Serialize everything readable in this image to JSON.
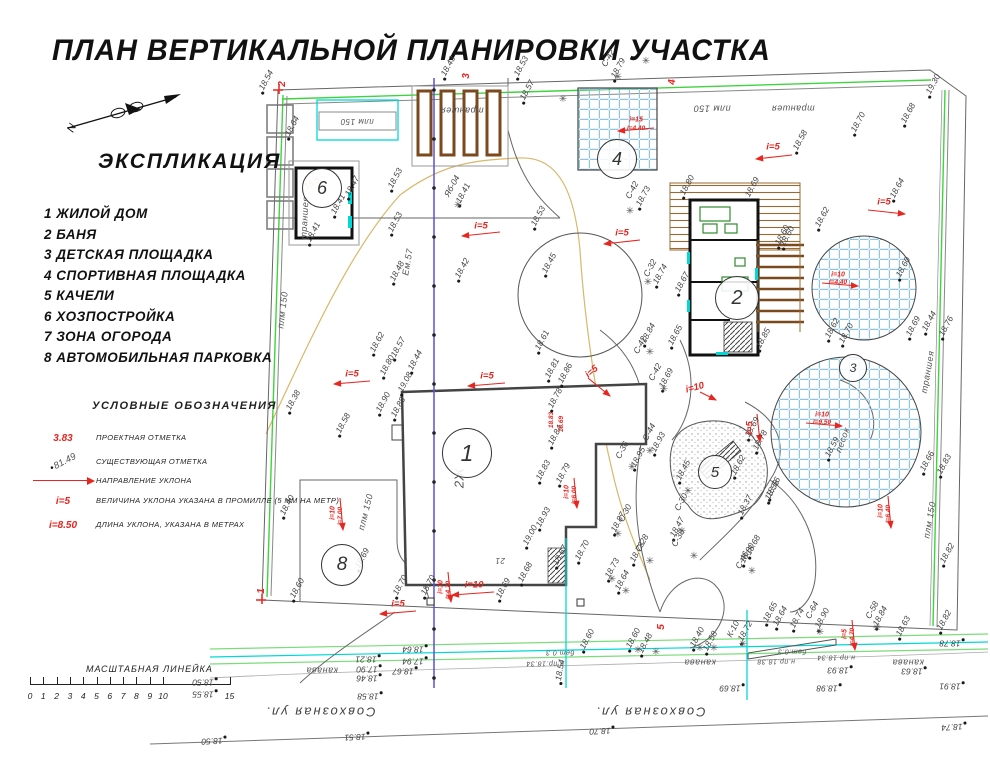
{
  "title": "ПЛАН ВЕРТИКАЛЬНОЙ ПЛАНИРОВКИ УЧАСТКА",
  "north_label": "N",
  "explication": {
    "heading": "ЭКСПЛИКАЦИЯ",
    "items": [
      "1 ЖИЛОЙ ДОМ",
      "2 БАНЯ",
      "3 ДЕТСКАЯ ПЛОЩАДКА",
      "4 СПОРТИВНАЯ ПЛОЩАДКА",
      "5 КАЧЕЛИ",
      "6 ХОЗПОСТРОЙКА",
      "7 ЗОНА ОГОРОДА",
      "8 АВТОМОБИЛЬНАЯ ПАРКОВКА"
    ]
  },
  "legend": {
    "heading": "УСЛОВНЫЕ ОБОЗНАЧЕНИЯ",
    "rows": [
      {
        "symbol": "3.83",
        "style": "red",
        "desc": "ПРОЕКТНАЯ ОТМЕТКА"
      },
      {
        "symbol": "81.49",
        "style": "exist",
        "desc": "СУЩЕСТВУЮЩАЯ ОТМЕТКА"
      },
      {
        "symbol": "",
        "style": "arrow",
        "desc": "НАПРАВЛЕНИЕ УКЛОНА"
      },
      {
        "symbol": "i=5",
        "style": "red",
        "desc": "ВЕЛИЧИНА УКЛОНА УКАЗАНА В ПРОМИЛЛЕ (5 ММ НА МЕТР)"
      },
      {
        "symbol": "i=8.50",
        "style": "red",
        "desc": "ДЛИНА УКЛОНА, УКАЗАНА В МЕТРАХ"
      }
    ]
  },
  "scale_bar": {
    "label": "МАСШТАБНАЯ ЛИНЕЙКА",
    "ticks": [
      "0",
      "1",
      "2",
      "3",
      "4",
      "5",
      "6",
      "7",
      "8",
      "9",
      "10",
      "15"
    ]
  },
  "plan": {
    "colors": {
      "red": "#e8251f",
      "fence_green": "#3fd43f",
      "light_green": "#7bdc7b",
      "cyan": "#00d8d8",
      "cable_blue": "#5a50d8",
      "contour_tan": "#d8b86a",
      "grid_blue": "#8fc6dd",
      "wood_brown": "#9a6a33"
    },
    "circles": [
      [
        "1",
        466,
        452,
        24
      ],
      [
        "2",
        736,
        297,
        21
      ],
      [
        "3",
        852,
        367,
        13
      ],
      [
        "4",
        616,
        158,
        19
      ],
      [
        "5",
        714,
        471,
        16
      ],
      [
        "6",
        321,
        187,
        19
      ],
      [
        "8",
        341,
        564,
        20
      ]
    ],
    "trees": [
      [
        618,
        78
      ],
      [
        646,
        62
      ],
      [
        563,
        100
      ],
      [
        630,
        212
      ],
      [
        648,
        283
      ],
      [
        650,
        353
      ],
      [
        664,
        390
      ],
      [
        650,
        452
      ],
      [
        632,
        468
      ],
      [
        618,
        535
      ],
      [
        650,
        562
      ],
      [
        688,
        492
      ],
      [
        682,
        532
      ],
      [
        694,
        557
      ],
      [
        752,
        572
      ],
      [
        612,
        580
      ],
      [
        626,
        592
      ],
      [
        638,
        651
      ],
      [
        656,
        653
      ],
      [
        700,
        649
      ],
      [
        714,
        649
      ],
      [
        743,
        645
      ],
      [
        820,
        633
      ],
      [
        877,
        629
      ],
      [
        458,
        206
      ]
    ],
    "labels": [
      [
        "18.54",
        266,
        80,
        -62,
        "e"
      ],
      [
        "18.64",
        292,
        126,
        -62,
        "e"
      ],
      [
        "18.47",
        352,
        186,
        -62,
        "e"
      ],
      [
        "18.41",
        338,
        204,
        -62,
        "e"
      ],
      [
        "18.41",
        313,
        232,
        -62,
        "e"
      ],
      [
        "18.53",
        395,
        178,
        -62,
        "e"
      ],
      [
        "18.53",
        395,
        222,
        -62,
        "e"
      ],
      [
        "18.48",
        397,
        271,
        -62,
        "e"
      ],
      [
        "18.43",
        448,
        66,
        -62,
        "e"
      ],
      [
        "18.53",
        521,
        66,
        -62,
        "e"
      ],
      [
        "18.57",
        527,
        90,
        -62,
        "e"
      ],
      [
        "18.53",
        538,
        216,
        -62,
        "e"
      ],
      [
        "18.45",
        549,
        263,
        -62,
        "e"
      ],
      [
        "18.42",
        462,
        268,
        -62,
        "e"
      ],
      [
        "18.41",
        463,
        193,
        -62,
        "e"
      ],
      [
        "18.40",
        287,
        505,
        -62,
        "e"
      ],
      [
        "18.38",
        293,
        400,
        -62,
        "e"
      ],
      [
        "18.58",
        343,
        423,
        -62,
        "e"
      ],
      [
        "18.79",
        618,
        68,
        -62,
        "e"
      ],
      [
        "19.30",
        933,
        84,
        -62,
        "e"
      ],
      [
        "18.68",
        908,
        113,
        -62,
        "e"
      ],
      [
        "18.70",
        858,
        122,
        -62,
        "e"
      ],
      [
        "18.58",
        800,
        140,
        -62,
        "e"
      ],
      [
        "18.64",
        897,
        188,
        -62,
        "e"
      ],
      [
        "18.62",
        822,
        217,
        -62,
        "e"
      ],
      [
        "18.60",
        782,
        235,
        -62,
        "e"
      ],
      [
        "18.80",
        687,
        185,
        -62,
        "e"
      ],
      [
        "18.69",
        752,
        187,
        -62,
        "e"
      ],
      [
        "18.73",
        643,
        196,
        -62,
        "e"
      ],
      [
        "18.74",
        660,
        274,
        -62,
        "e"
      ],
      [
        "18.67",
        682,
        282,
        -62,
        "e"
      ],
      [
        "18.65",
        675,
        335,
        -62,
        "e"
      ],
      [
        "18.85",
        763,
        338,
        -62,
        "e"
      ],
      [
        "18.84",
        648,
        333,
        -62,
        "e"
      ],
      [
        "18.69",
        666,
        378,
        -62,
        "e"
      ],
      [
        "18.62",
        377,
        342,
        -62,
        "e"
      ],
      [
        "18.57",
        398,
        347,
        -62,
        "e"
      ],
      [
        "18.44",
        415,
        360,
        -62,
        "e"
      ],
      [
        "18.80",
        387,
        365,
        -62,
        "e"
      ],
      [
        "19.08",
        405,
        382,
        -62,
        "e"
      ],
      [
        "18.90",
        383,
        402,
        -62,
        "e"
      ],
      [
        "18.88",
        398,
        407,
        -62,
        "e"
      ],
      [
        "18.61",
        542,
        340,
        -62,
        "e"
      ],
      [
        "18.81",
        552,
        368,
        -62,
        "e"
      ],
      [
        "18.86",
        565,
        373,
        -62,
        "e"
      ],
      [
        "18.78",
        555,
        398,
        -62,
        "e"
      ],
      [
        "18.84",
        555,
        435,
        -62,
        "e"
      ],
      [
        "18.83",
        543,
        470,
        -62,
        "e"
      ],
      [
        "18.79",
        563,
        473,
        -62,
        "e"
      ],
      [
        "18.93",
        543,
        517,
        -62,
        "e"
      ],
      [
        "19.00",
        530,
        535,
        -62,
        "e"
      ],
      [
        "18.67",
        560,
        555,
        -62,
        "e"
      ],
      [
        "18.70",
        582,
        550,
        -62,
        "e"
      ],
      [
        "18.68",
        525,
        572,
        -62,
        "e"
      ],
      [
        "18.69",
        503,
        588,
        -62,
        "e"
      ],
      [
        "18.70",
        400,
        585,
        -62,
        "e"
      ],
      [
        "18.60",
        787,
        236,
        -62,
        "e"
      ],
      [
        "18.60",
        903,
        267,
        -62,
        "e"
      ],
      [
        "18.62",
        832,
        328,
        -62,
        "e"
      ],
      [
        "18.70",
        846,
        333,
        -62,
        "e"
      ],
      [
        "18.69",
        913,
        326,
        -62,
        "e"
      ],
      [
        "18.44",
        929,
        321,
        -62,
        "e"
      ],
      [
        "18.76",
        946,
        326,
        -62,
        "e"
      ],
      [
        "18.59",
        832,
        447,
        -62,
        "e"
      ],
      [
        "18.56",
        773,
        487,
        -62,
        "e"
      ],
      [
        "18.66",
        927,
        461,
        -62,
        "e"
      ],
      [
        "18.83",
        944,
        464,
        -62,
        "e"
      ],
      [
        "18.93",
        658,
        442,
        -62,
        "e"
      ],
      [
        "18.95",
        638,
        457,
        -62,
        "e"
      ],
      [
        "18.87",
        618,
        522,
        -62,
        "e"
      ],
      [
        "18.78",
        637,
        552,
        -62,
        "e"
      ],
      [
        "18.73",
        612,
        568,
        -62,
        "e"
      ],
      [
        "18.64",
        622,
        580,
        -62,
        "e"
      ],
      [
        "18.45",
        683,
        470,
        -62,
        "e"
      ],
      [
        "18.47",
        677,
        527,
        -62,
        "e"
      ],
      [
        "18.62",
        738,
        465,
        -62,
        "e"
      ],
      [
        "18.78",
        760,
        440,
        -62,
        "e"
      ],
      [
        "18.69",
        752,
        427,
        -62,
        "e"
      ],
      [
        "18.37",
        745,
        505,
        -62,
        "e"
      ],
      [
        "18.56",
        772,
        490,
        -62,
        "e"
      ],
      [
        "18.80",
        747,
        553,
        -62,
        "e"
      ],
      [
        "18.68",
        753,
        545,
        -62,
        "e"
      ],
      [
        "18.60",
        633,
        638,
        -62,
        "e"
      ],
      [
        "18.48",
        645,
        643,
        -62,
        "e"
      ],
      [
        "18.40",
        697,
        637,
        -62,
        "e"
      ],
      [
        "18.58",
        710,
        641,
        -62,
        "e"
      ],
      [
        "18.72",
        745,
        631,
        -62,
        "e"
      ],
      [
        "18.65",
        770,
        612,
        -62,
        "e"
      ],
      [
        "18.64",
        780,
        616,
        -62,
        "e"
      ],
      [
        "18.74",
        797,
        618,
        -62,
        "e"
      ],
      [
        "18.90",
        822,
        618,
        -62,
        "e"
      ],
      [
        "18.84",
        880,
        616,
        -62,
        "e"
      ],
      [
        "18.63",
        903,
        626,
        -62,
        "e"
      ],
      [
        "18.82",
        944,
        620,
        -62,
        "e"
      ],
      [
        "18.82",
        947,
        553,
        -62,
        "e"
      ],
      [
        "18.60",
        587,
        639,
        -62,
        "e"
      ],
      [
        "18.69",
        362,
        558,
        -62,
        "e"
      ],
      [
        "18.60",
        297,
        588,
        -62,
        "e"
      ],
      [
        "18.70",
        428,
        585,
        -62,
        "e"
      ],
      [
        "18.50",
        203,
        682,
        180,
        "e"
      ],
      [
        "18.55",
        203,
        694,
        180,
        "e"
      ],
      [
        "18.64",
        413,
        649,
        180,
        "e"
      ],
      [
        "17.94",
        413,
        661,
        180,
        "e"
      ],
      [
        "18.67",
        403,
        671,
        180,
        "e"
      ],
      [
        "18.21",
        366,
        659,
        180,
        "e"
      ],
      [
        "17.90",
        367,
        669,
        180,
        "e"
      ],
      [
        "18.46",
        367,
        678,
        180,
        "e"
      ],
      [
        "18.58",
        368,
        696,
        180,
        "e"
      ],
      [
        "18.69",
        730,
        688,
        180,
        "e"
      ],
      [
        "18.98",
        827,
        688,
        180,
        "e"
      ],
      [
        "18.93",
        838,
        670,
        180,
        "e"
      ],
      [
        "18.63",
        912,
        671,
        180,
        "e"
      ],
      [
        "18.91",
        950,
        686,
        180,
        "e"
      ],
      [
        "18.78",
        950,
        643,
        180,
        "e"
      ],
      [
        "18.54",
        560,
        670,
        -80,
        "e"
      ],
      [
        "18.50",
        212,
        741,
        177,
        "e"
      ],
      [
        "18.51",
        355,
        737,
        177,
        "e"
      ],
      [
        "18.70",
        600,
        731,
        177,
        "e"
      ],
      [
        "18.74",
        952,
        727,
        177,
        "e"
      ],
      [
        "С-42",
        608,
        58,
        -62,
        "s"
      ],
      [
        "С-42",
        632,
        190,
        -62,
        "s"
      ],
      [
        "С-32",
        650,
        268,
        -62,
        "s"
      ],
      [
        "С-42",
        640,
        345,
        -62,
        "s"
      ],
      [
        "С-42",
        655,
        372,
        -62,
        "s"
      ],
      [
        "С-44",
        649,
        432,
        -62,
        "s"
      ],
      [
        "С-36",
        622,
        450,
        -62,
        "s"
      ],
      [
        "С-30",
        625,
        513,
        -62,
        "s"
      ],
      [
        "С-30",
        681,
        502,
        -62,
        "s"
      ],
      [
        "С-28",
        642,
        543,
        -62,
        "s"
      ],
      [
        "С-38",
        678,
        538,
        -62,
        "s"
      ],
      [
        "С-46",
        742,
        560,
        -62,
        "s"
      ],
      [
        "С-58",
        872,
        610,
        -62,
        "s"
      ],
      [
        "К-10",
        733,
        629,
        -62,
        "s"
      ],
      [
        "С-64",
        812,
        610,
        -62,
        "s"
      ],
      [
        "Яб-04",
        452,
        186,
        -62,
        "s"
      ],
      [
        "i=5",
        481,
        226,
        0,
        "p"
      ],
      [
        "i=5",
        773,
        147,
        0,
        "p"
      ],
      [
        "i=5",
        884,
        202,
        0,
        "p"
      ],
      [
        "i=5",
        622,
        233,
        0,
        "p"
      ],
      [
        "i=5",
        487,
        376,
        0,
        "p"
      ],
      [
        "i=5",
        352,
        374,
        0,
        "p"
      ],
      [
        "i=5",
        398,
        604,
        0,
        "p"
      ],
      [
        "i=10",
        474,
        585,
        0,
        "p"
      ],
      [
        "i=5",
        592,
        372,
        -40,
        "p"
      ],
      [
        "i=5",
        750,
        428,
        -90,
        "p"
      ],
      [
        "i=10",
        695,
        388,
        -15,
        "p"
      ],
      [
        "i=15",
        636,
        120,
        0,
        "p",
        7
      ],
      [
        "l=4.40",
        636,
        129,
        0,
        "p",
        6.5
      ],
      [
        "i=10",
        838,
        275,
        0,
        "p",
        7
      ],
      [
        "l=4.40",
        838,
        283,
        0,
        "p",
        6.5
      ],
      [
        "i=10",
        822,
        415,
        0,
        "p",
        7
      ],
      [
        "l=9.50",
        822,
        423,
        0,
        "p",
        6.5
      ],
      [
        "i=10",
        333,
        513,
        -90,
        "p",
        7
      ],
      [
        "l=7.00",
        341,
        516,
        -90,
        "p",
        6.5
      ],
      [
        "i=10",
        441,
        587,
        -90,
        "p",
        7
      ],
      [
        "l=4.70",
        449,
        590,
        -90,
        "p",
        6.5
      ],
      [
        "i=10",
        567,
        492,
        -90,
        "p",
        7
      ],
      [
        "l=6.00",
        575,
        495,
        -90,
        "p",
        6.5
      ],
      [
        "i=10",
        881,
        511,
        -90,
        "p",
        7
      ],
      [
        "l=6.40",
        889,
        514,
        -90,
        "p",
        6.5
      ],
      [
        "i=5",
        845,
        634,
        -90,
        "p",
        7
      ],
      [
        "l=4.70",
        853,
        637,
        -90,
        "p",
        6.5
      ],
      [
        "18.83",
        552,
        420,
        -90,
        "p",
        6.5
      ],
      [
        "18.69",
        562,
        424,
        -90,
        "p",
        6.5
      ],
      [
        "2",
        283,
        84,
        -90,
        "rn"
      ],
      [
        "3",
        467,
        76,
        -90,
        "rn"
      ],
      [
        "4",
        673,
        82,
        -90,
        "rn"
      ],
      [
        "1",
        262,
        591,
        -90,
        "rn"
      ],
      [
        "5",
        662,
        627,
        -90,
        "rn"
      ],
      [
        "плм 150",
        283,
        310,
        -83,
        "u"
      ],
      [
        "плм 150",
        357,
        121,
        180,
        "u",
        8
      ],
      [
        "плм 150",
        712,
        108,
        180,
        "u"
      ],
      [
        "плм 150",
        930,
        520,
        -80,
        "u"
      ],
      [
        "плм 150",
        366,
        512,
        -76,
        "u"
      ],
      [
        "траншея",
        305,
        218,
        -87,
        "u"
      ],
      [
        "траншея",
        462,
        110,
        180,
        "u"
      ],
      [
        "траншея",
        793,
        108,
        180,
        "u"
      ],
      [
        "траншея",
        928,
        372,
        -80,
        "u"
      ],
      [
        "песок",
        843,
        440,
        -70,
        "u"
      ],
      [
        "канава",
        322,
        670,
        180,
        "u"
      ],
      [
        "канава",
        700,
        662,
        180,
        "u"
      ],
      [
        "канава",
        908,
        662,
        180,
        "u"
      ],
      [
        "бет.0.3",
        560,
        652,
        180,
        "u",
        7
      ],
      [
        "бет.0.3",
        792,
        651,
        180,
        "u",
        7
      ],
      [
        "н.пр.18.34",
        545,
        663,
        180,
        "u",
        7
      ],
      [
        "н.пр.18.38",
        776,
        661,
        180,
        "u",
        7
      ],
      [
        "н.пр.18.34",
        836,
        657,
        180,
        "u",
        7
      ],
      [
        "Ем.57",
        408,
        262,
        -80,
        "u"
      ],
      [
        "2Ж",
        459,
        478,
        -90,
        "u",
        13
      ],
      [
        "21",
        500,
        560,
        180,
        "u",
        8
      ],
      [
        "18.5",
        312,
        183,
        -33,
        "t"
      ],
      [
        "Совхозная ул.",
        320,
        712,
        180,
        "st"
      ],
      [
        "Совхозная ул.",
        650,
        712,
        180,
        "st"
      ]
    ]
  }
}
